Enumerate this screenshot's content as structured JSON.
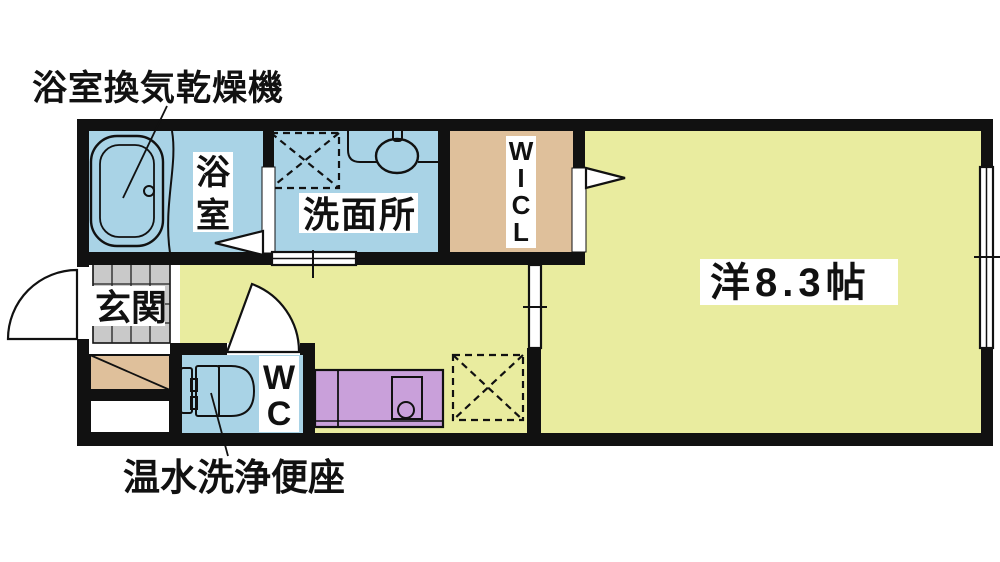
{
  "plan": {
    "annotations": {
      "bath_dryer": "浴室換気乾燥機",
      "toilet_seat": "温水洗浄便座"
    },
    "rooms": {
      "bathroom": {
        "label": "浴室",
        "chars": [
          "浴",
          "室"
        ]
      },
      "washroom": {
        "label": "洗面所"
      },
      "wicl": {
        "label": "WICL",
        "chars": [
          "W",
          "I",
          "C",
          "L"
        ]
      },
      "wc": {
        "label": "WC",
        "chars": [
          "W",
          "C"
        ]
      },
      "entrance": {
        "label": "玄関"
      },
      "main_room": {
        "label": "洋8.3帖"
      }
    },
    "colors": {
      "wet_area_floor": "#a9d3e6",
      "room_floor": "#e9ec9f",
      "closet_floor": "#dfc09b",
      "kitchen_counter": "#c9a0da",
      "entrance_tile": "#c9c9c9",
      "wall": "#111111"
    }
  }
}
